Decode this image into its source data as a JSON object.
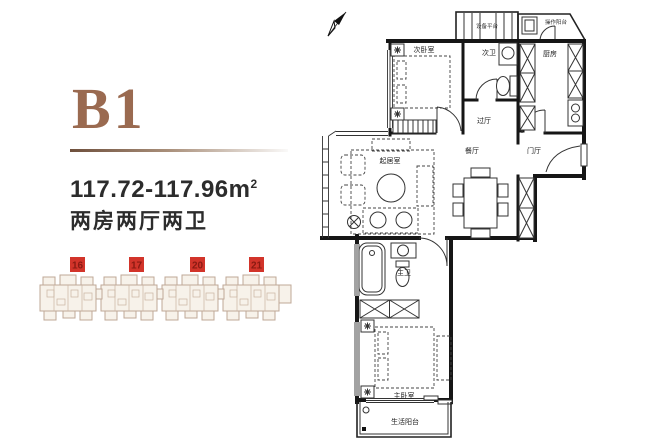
{
  "left_panel": {
    "unit_name": "B1",
    "area_value": "117.72-117.96m",
    "area_sup": "2",
    "layout_text": "两房两厅两卫"
  },
  "keyplan": {
    "buildings": [
      {
        "label": "16"
      },
      {
        "label": "17"
      },
      {
        "label": "20"
      },
      {
        "label": "21"
      }
    ],
    "badge_color": "#d2342a",
    "building_color": "#bfa897"
  },
  "plan": {
    "compass": "north-arrow",
    "rooms": {
      "equipment_platform": "设备平台",
      "work_balcony": "操作阳台",
      "second_bedroom": "次卧室",
      "second_bath": "次卫",
      "kitchen": "厨房",
      "pass_hall": "过厅",
      "dining_room": "餐厅",
      "entry_hall": "门厅",
      "living_room": "起居室",
      "master_bath": "主卫",
      "master_bedroom": "主卧室",
      "life_balcony": "生活阳台"
    }
  }
}
